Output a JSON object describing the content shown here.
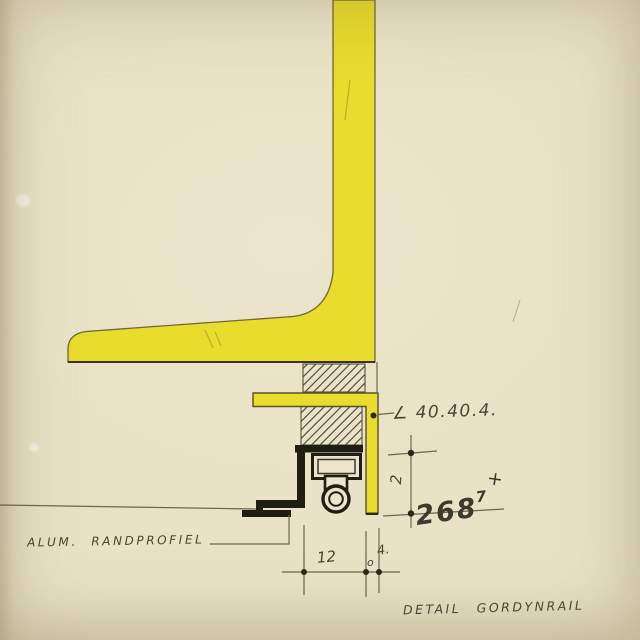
{
  "sheet": {
    "title": "DETAIL GORDYNRAIL",
    "labels": {
      "angle_spec": "∠ 40.40.4.",
      "edge_profile": "ALUM. RANDPROFIEL",
      "dim_height": "268",
      "dim_height_sup": "7",
      "dim_height_plus": "+",
      "dim_rail_depth": "2",
      "dim_bottom_width": "12",
      "dim_gap_o": "o",
      "dim_gap": "4."
    },
    "colors": {
      "paper": "#eae2c6",
      "yellow": "#e9dc2d",
      "ink": "#201d13",
      "pencil": "#6b6650",
      "hand": "#4a4634",
      "hatch": "#55503c",
      "outline": "#6e6838"
    }
  }
}
